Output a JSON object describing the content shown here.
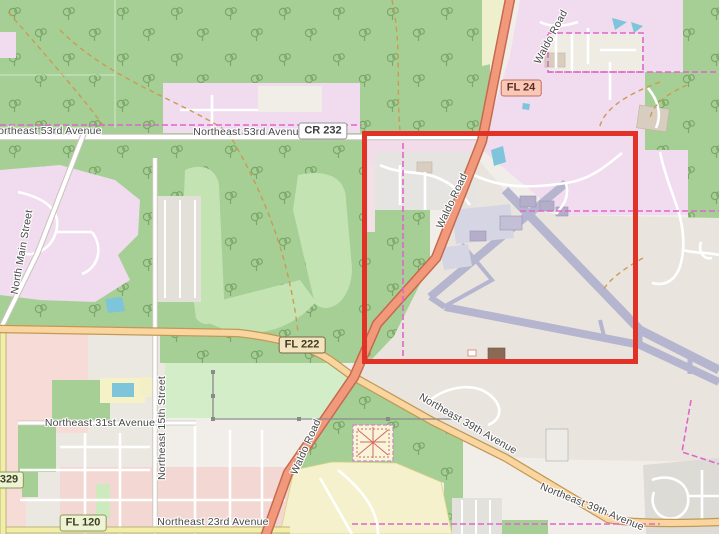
{
  "map": {
    "kind": "openstreetmap-style map with highlighted airport area",
    "highlight": {
      "x": 362,
      "y": 131,
      "width": 276,
      "height": 233,
      "color": "#e23227"
    },
    "colors": {
      "background": "#f1eee9",
      "forest": "#a6cf96",
      "scrub": "#c3e3b3",
      "grass": "#d3edc8",
      "residential_pink": "#f1dbee",
      "residential_rose": "#f4d9d4",
      "aerodrome": "#e9e5de",
      "runway": "#b6b5cf",
      "apron": "#d6d5e3",
      "water": "#7ec4da",
      "trunk_road": "#f2997b",
      "primary_road": "#fbd5a0",
      "tertiary_road": "#f2eea8",
      "boundary": "#df66cb",
      "highlight": "#e23227"
    },
    "road_labels": [
      {
        "id": "ne-53rd-avenue-west",
        "text": "Northeast 53rd Avenue",
        "x": 46,
        "y": 131,
        "rotation": 0
      },
      {
        "id": "ne-53rd-avenue-center",
        "text": "Northeast 53rd Avenue",
        "x": 249,
        "y": 132,
        "rotation": 0
      },
      {
        "id": "waldo-road-top",
        "text": "Waldo Road",
        "x": 551,
        "y": 37,
        "rotation": -62
      },
      {
        "id": "waldo-road-middle",
        "text": "Waldo Road",
        "x": 452,
        "y": 201,
        "rotation": -65
      },
      {
        "id": "waldo-road-bottom",
        "text": "Waldo Road",
        "x": 306,
        "y": 447,
        "rotation": -66
      },
      {
        "id": "ne-39th-avenue-west",
        "text": "Northeast 39th Avenue",
        "x": 468,
        "y": 424,
        "rotation": 30
      },
      {
        "id": "ne-39th-avenue-east",
        "text": "Northeast 39th Avenue",
        "x": 592,
        "y": 507,
        "rotation": 22
      },
      {
        "id": "north-main-street",
        "text": "North Main Street",
        "x": 22,
        "y": 252,
        "rotation": -80
      },
      {
        "id": "ne-15th-street",
        "text": "Northeast 15th Street",
        "x": 162,
        "y": 428,
        "rotation": -90
      },
      {
        "id": "ne-31st-avenue",
        "text": "Northeast 31st Avenue",
        "x": 100,
        "y": 423,
        "rotation": 0
      },
      {
        "id": "ne-23rd-avenue",
        "text": "Northeast 23rd Avenue",
        "x": 213,
        "y": 522,
        "rotation": 0
      }
    ],
    "route_shields": [
      {
        "text": "FL 24",
        "style": "trunk",
        "x": 521,
        "y": 88
      },
      {
        "text": "CR 232",
        "style": "county",
        "x": 323,
        "y": 131
      },
      {
        "text": "FL 222",
        "style": "primary",
        "x": 302,
        "y": 345
      },
      {
        "text": "FL 120",
        "style": "secondary",
        "x": 83,
        "y": 523
      },
      {
        "text": "329",
        "style": "secondary",
        "x": 9,
        "y": 480
      }
    ]
  }
}
